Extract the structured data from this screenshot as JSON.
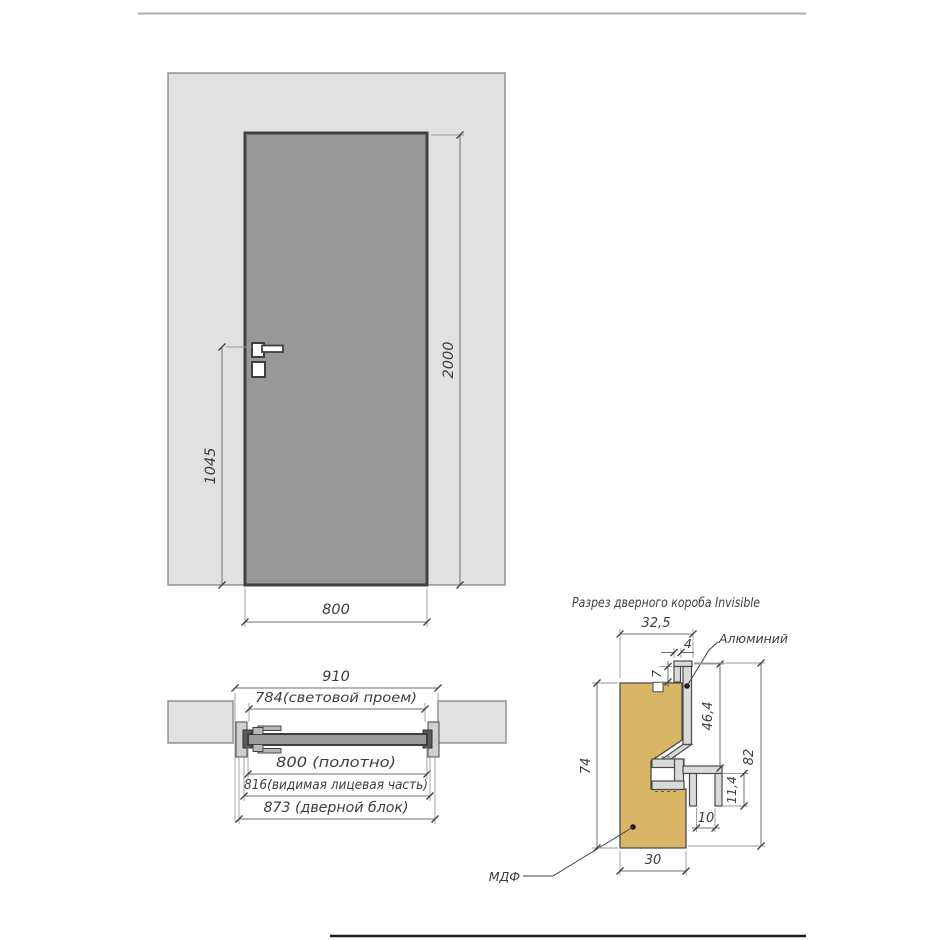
{
  "drawing": {
    "front_view": {
      "dim_width": "800",
      "dim_height": "2000",
      "dim_handle_height": "1045"
    },
    "plan_view": {
      "dim_overall": "910",
      "dim_clear_opening": "784(световой проем)",
      "dim_leaf": "800 (полотно)",
      "dim_visible_face": "816(видимая лицевая часть)",
      "dim_door_block": "873 (дверной блок)"
    },
    "section_view": {
      "title": "Разрез дверного короба Invisible",
      "label_aluminum": "Алюминий",
      "label_mdf": "МДФ",
      "dim_frame_width": "32,5",
      "dim_lip_width": "4",
      "dim_lip_depth": "7",
      "dim_reveal": "46,4",
      "dim_total_height": "82",
      "dim_mdf_height": "74",
      "dim_leg_height": "11,4",
      "dim_leg_gap": "10",
      "dim_mdf_width": "30"
    },
    "colors": {
      "wall": "#e1e1e1",
      "door": "#989898",
      "leaf_plan": "#9a9a9a",
      "mdf": "#d9b566",
      "aluminum": "#dadada",
      "white": "#ffffff"
    }
  }
}
